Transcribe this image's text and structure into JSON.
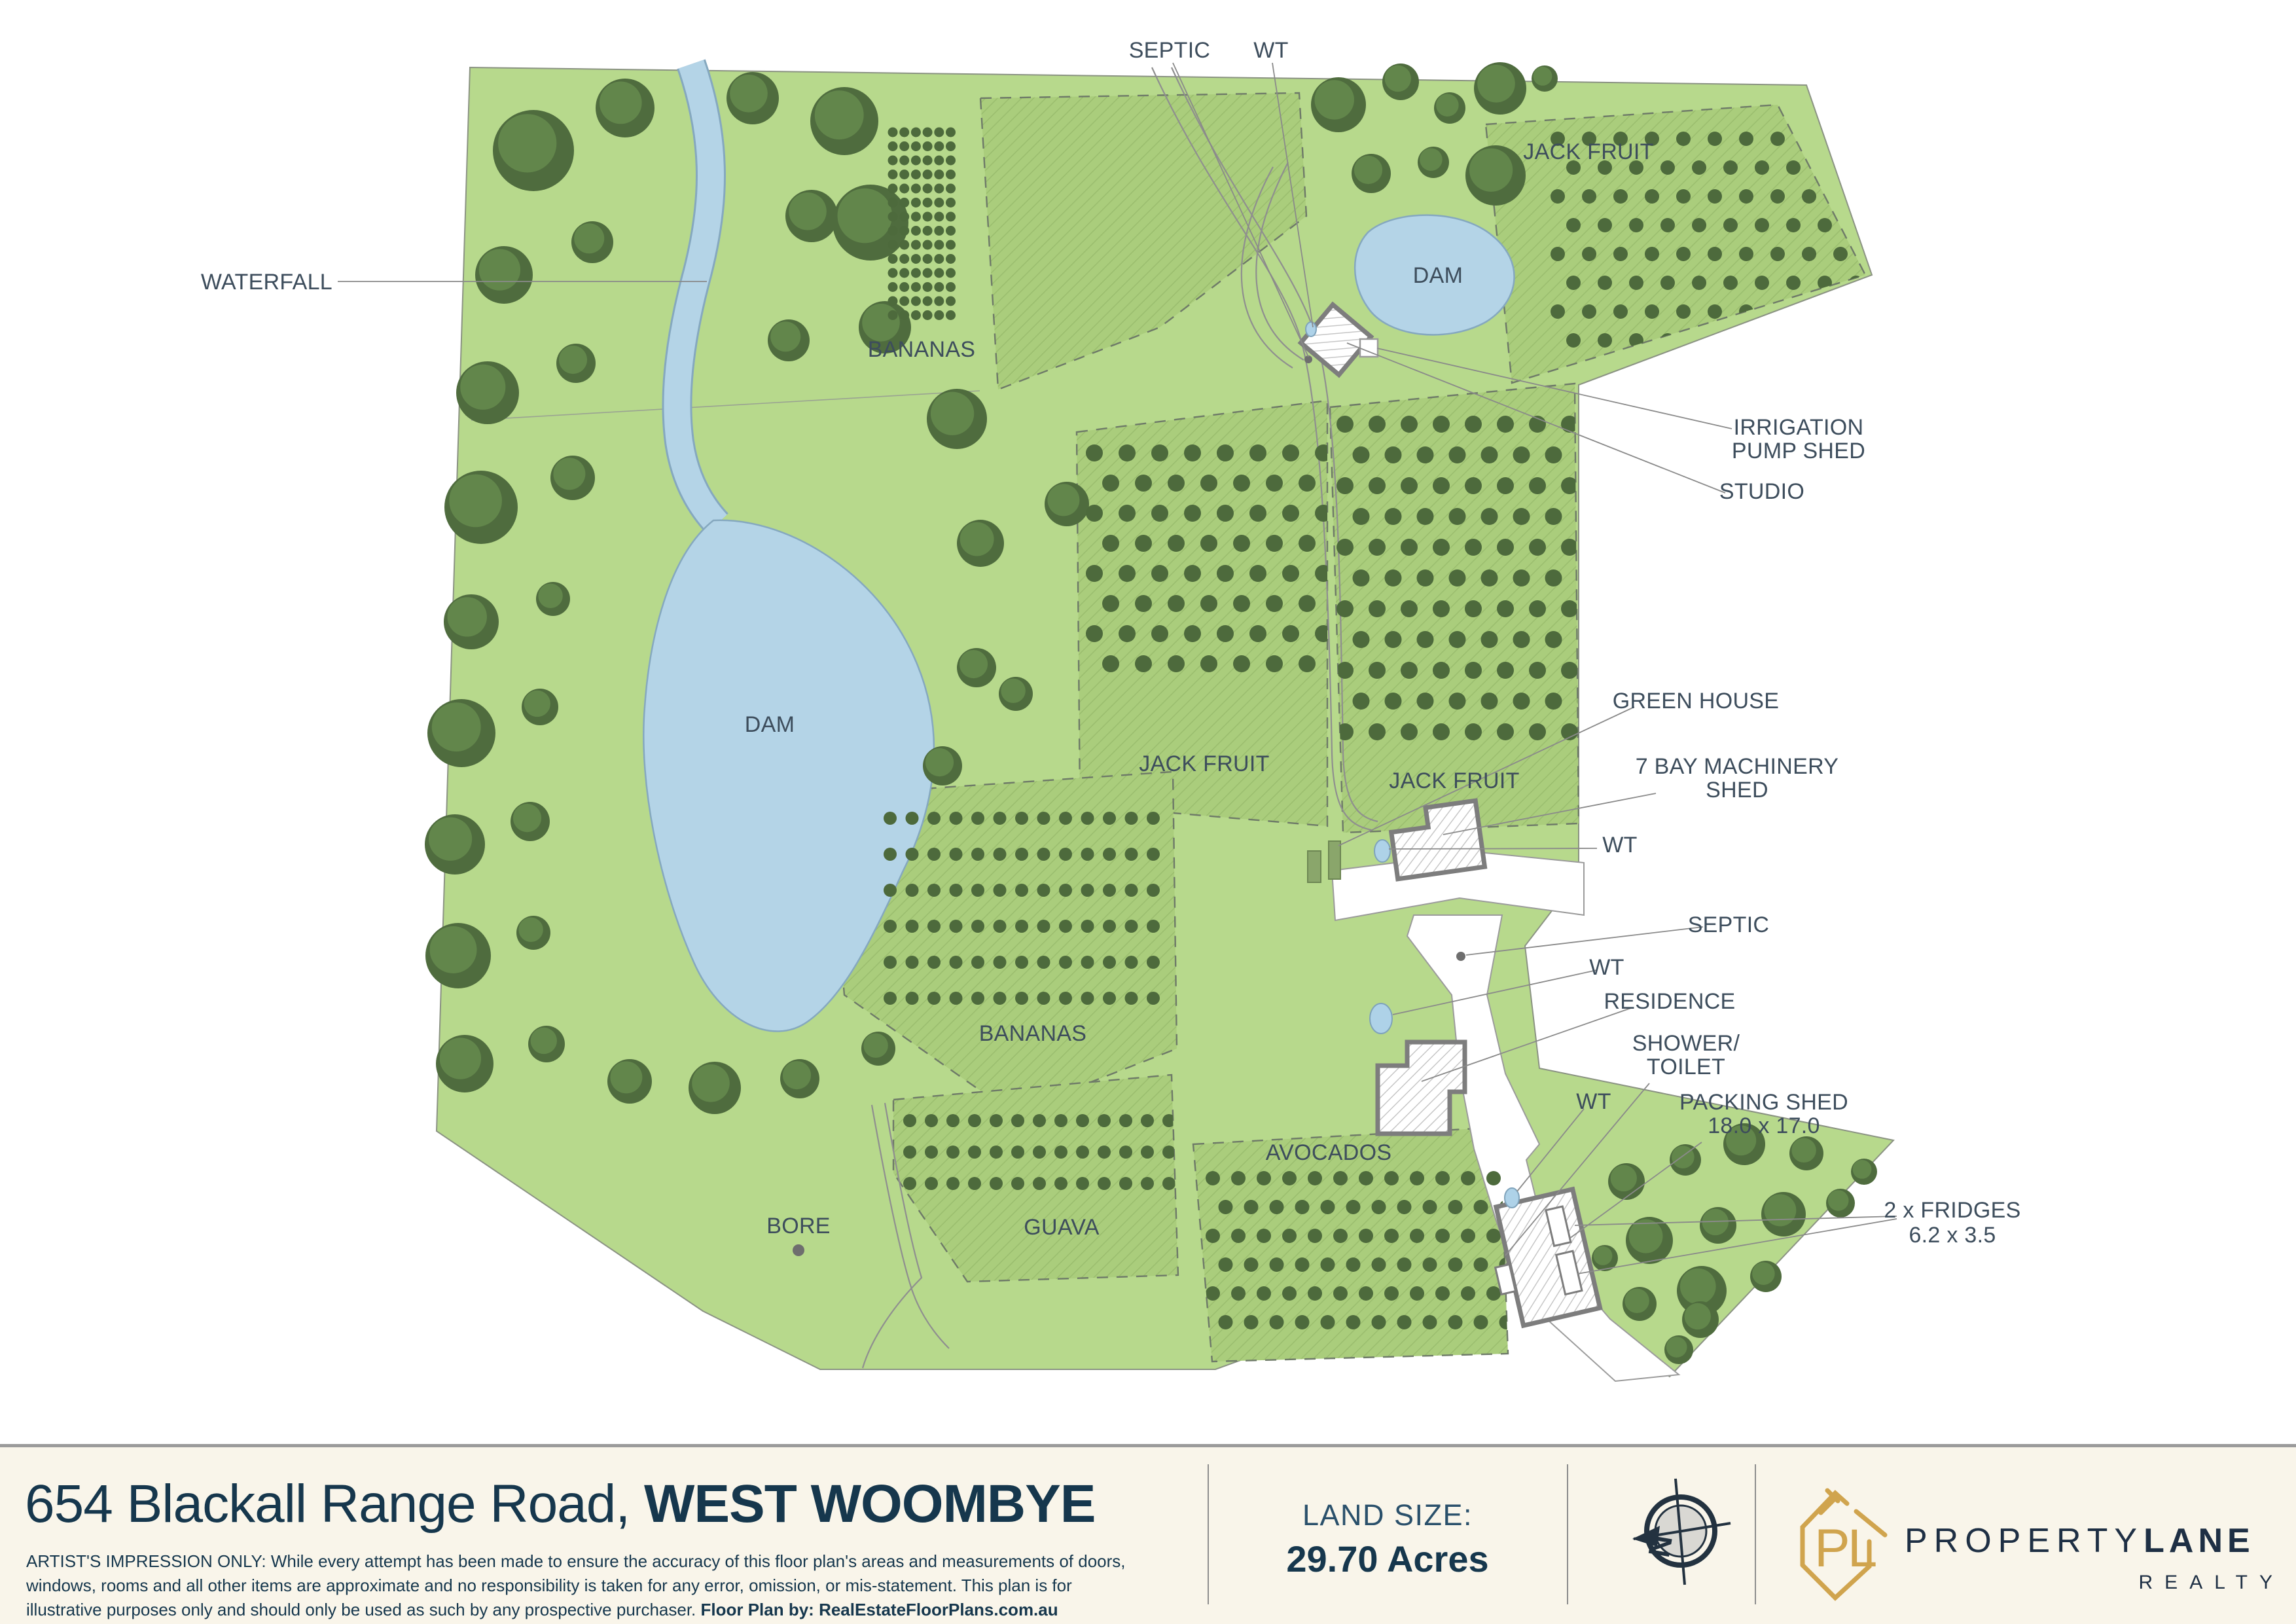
{
  "map": {
    "area_labels": {
      "waterfall": "WATERFALL",
      "bananas_top": "BANANAS",
      "jackfruit_topright": "JACK FRUIT",
      "dam_top": "DAM",
      "dam_left": "DAM",
      "jackfruit_left": "JACK FRUIT",
      "jackfruit_right": "JACK FRUIT",
      "bananas_center": "BANANAS",
      "guava": "GUAVA",
      "avocados": "AVOCADOS",
      "bore": "BORE"
    },
    "callouts": {
      "septic_top": "SEPTIC",
      "wt_top": "WT",
      "irrigation_line1": "IRRIGATION",
      "irrigation_line2": "PUMP SHED",
      "studio": "STUDIO",
      "green_house": "GREEN HOUSE",
      "machinery_line1": "7 BAY MACHINERY",
      "machinery_line2": "SHED",
      "wt_shed": "WT",
      "septic_mid": "SEPTIC",
      "wt_mid": "WT",
      "residence": "RESIDENCE",
      "shower_line1": "SHOWER/",
      "shower_line2": "TOILET",
      "wt_bottom": "WT",
      "packing_line1": "PACKING SHED",
      "packing_line2": "18.0 x 17.0",
      "fridges_line1": "2 x FRIDGES",
      "fridges_line2": "6.2 x 3.5"
    }
  },
  "footer": {
    "address_regular": "654 Blackall Range Road, ",
    "address_bold": "WEST WOOMBYE",
    "disclaimer_line1": "ARTIST'S IMPRESSION ONLY: While every attempt has been made to ensure the accuracy of this floor plan's areas and measurements of doors,",
    "disclaimer_line2": "windows, rooms and all other items are approximate and no responsibility is taken for any error, omission, or mis-statement. This plan is for",
    "disclaimer_line3": "illustrative purposes only and should only be used as such by any prospective purchaser. ",
    "disclaimer_bold": "Floor Plan by: RealEstateFloorPlans.com.au",
    "land_size_label": "LAND SIZE:",
    "land_size_value": "29.70 Acres",
    "compass_letter": "N",
    "logo": {
      "mark_letters": "PL",
      "name_regular": "PROPERTY",
      "name_bold": "LANE",
      "subtitle": "REALTY"
    }
  },
  "colors": {
    "grass": "#b7d98c",
    "orchard": "#aacd7c",
    "water": "#b4d4e7",
    "tree": "#53743f",
    "label": "#3d4d5c",
    "navy": "#16374d",
    "gold": "#d0a44e",
    "cream": "#f9f5ea"
  }
}
